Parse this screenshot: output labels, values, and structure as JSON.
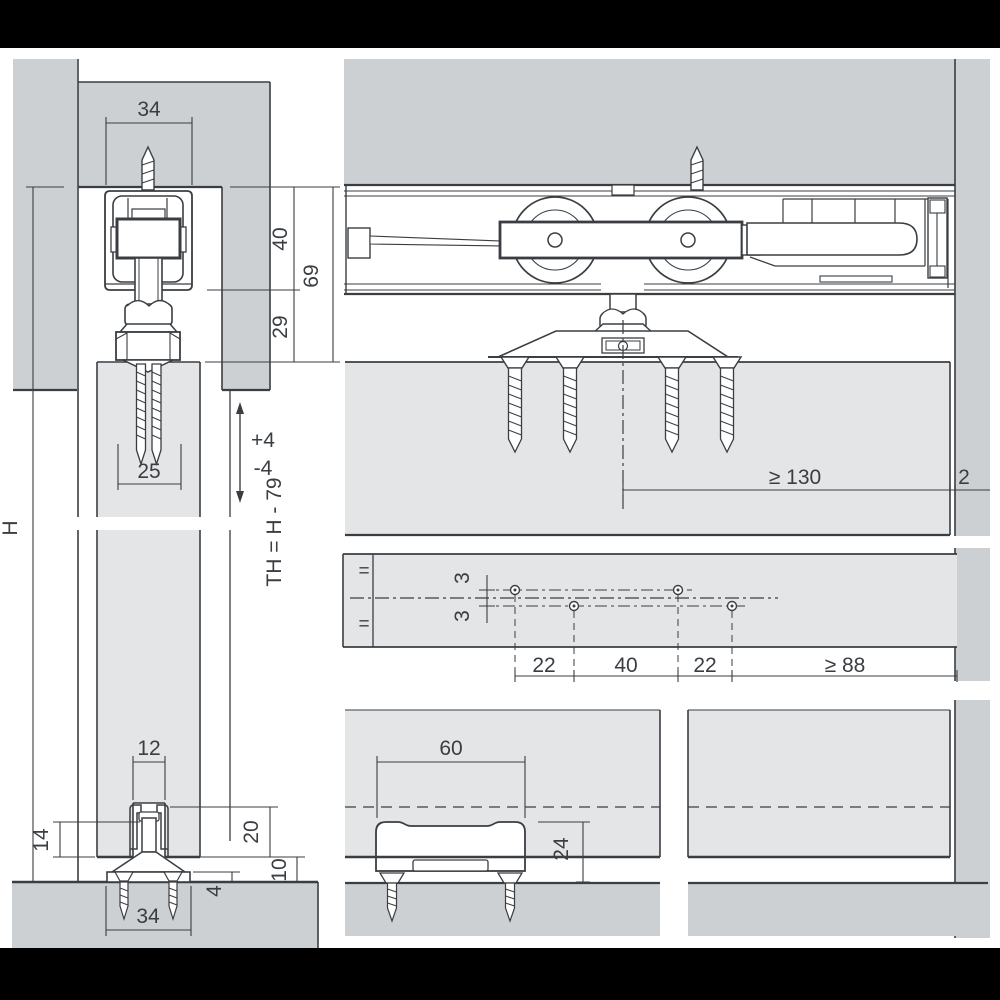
{
  "colors": {
    "background": "#ffffff",
    "panel_gray": "#cdd0d3",
    "door_gray": "#e3e5e7",
    "line_dark": "#3a3e42",
    "bar_black": "#000000"
  },
  "views": {
    "front_section": {
      "dims": {
        "track_width": "34",
        "roller_height": "40",
        "assembly_height": "69",
        "hanger_height": "29",
        "fixing_screw_length": "25",
        "height_adjust_up": "+4",
        "height_adjust_down": "-4",
        "door_height": "H",
        "door_height_formula": "TH = H - 79"
      }
    },
    "floor_guide_front": {
      "dims": {
        "groove_width": "12",
        "guide_profile_height": "14",
        "groove_depth": "20",
        "floor_clearance": "10",
        "base_plate_thickness": "4",
        "base_plate_width": "34"
      }
    },
    "side_section": {
      "dims": {
        "min_side_clearance": "≥ 130",
        "wall_gap": "2"
      }
    },
    "drilling_template": {
      "dims": {
        "hole_offset_above": "3",
        "hole_offset_below": "3",
        "hole_pitch_a": "22",
        "hole_pitch_b": "40",
        "hole_pitch_c": "22",
        "min_edge_distance": "≥ 88",
        "equal_mark_top": "=",
        "equal_mark_bottom": "="
      }
    },
    "floor_guide_side": {
      "dims": {
        "guide_length": "60",
        "guide_total_height": "24"
      }
    }
  }
}
